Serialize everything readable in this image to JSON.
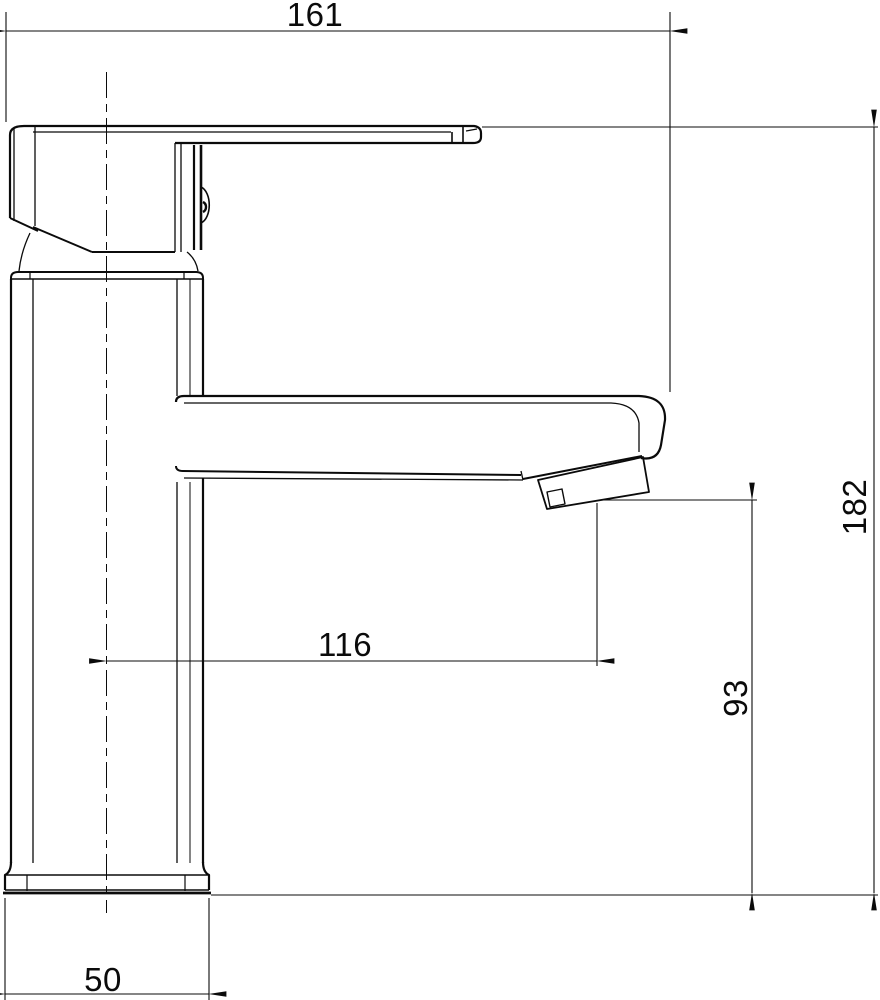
{
  "drawing": {
    "subject": "single-lever basin mixer tap, side view technical drawing"
  },
  "colors": {
    "line": "#0b0b0b",
    "background": "#ffffff"
  },
  "dimensions": {
    "overall_length": "161",
    "overall_height": "182",
    "spout_reach": "116",
    "spout_outlet_height": "93",
    "base_width": "50"
  }
}
